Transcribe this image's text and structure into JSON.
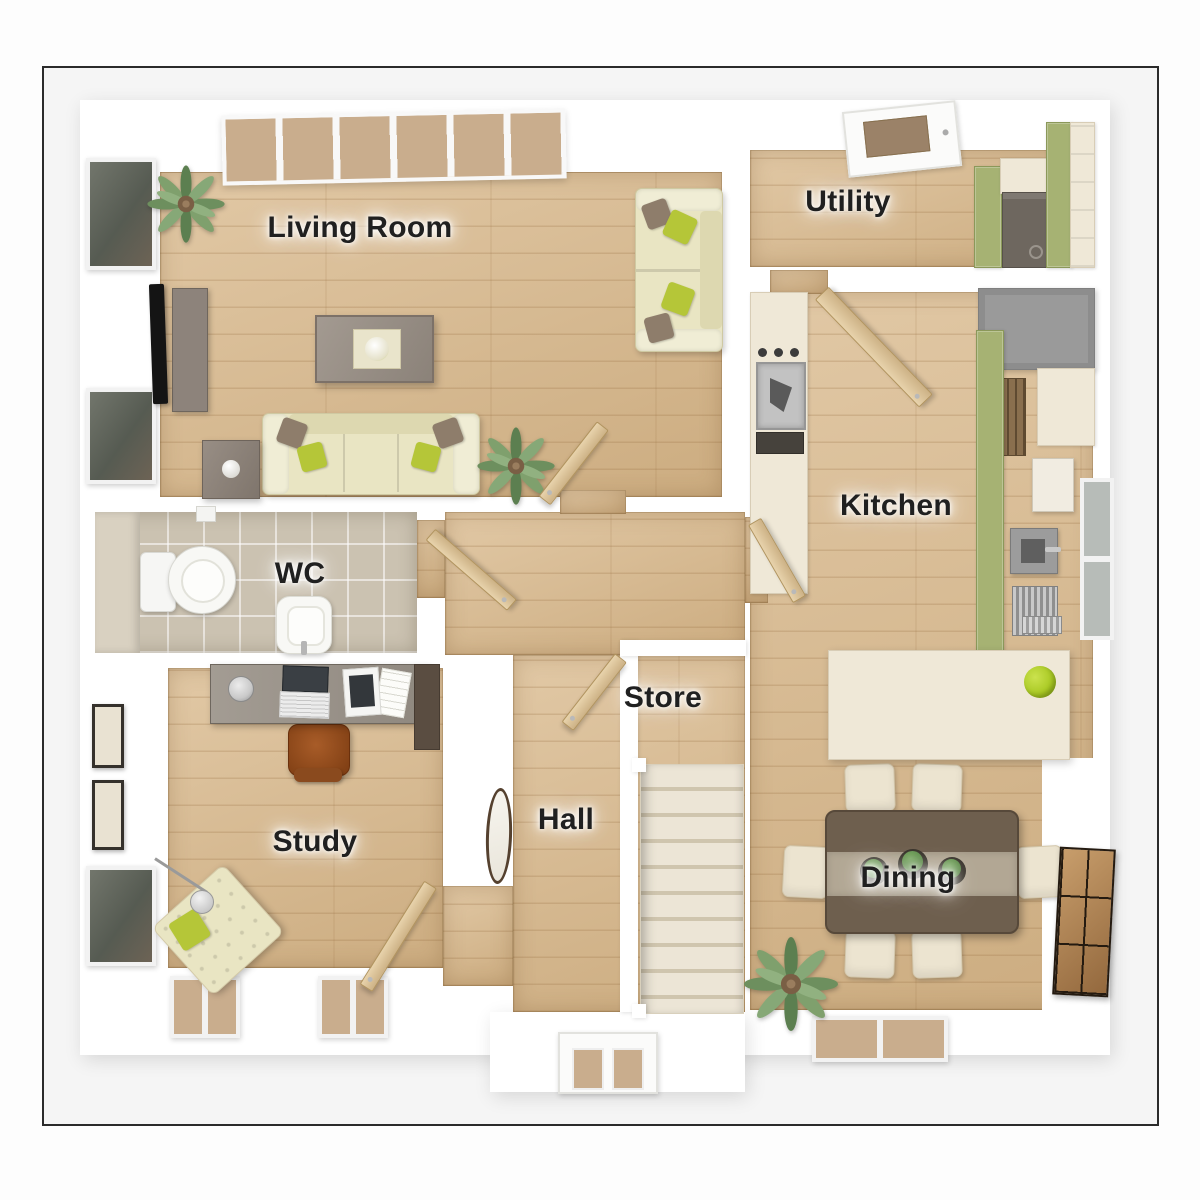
{
  "rooms": [
    {
      "id": "living-room",
      "label": "Living Room"
    },
    {
      "id": "utility",
      "label": "Utility"
    },
    {
      "id": "kitchen",
      "label": "Kitchen"
    },
    {
      "id": "wc",
      "label": "WC"
    },
    {
      "id": "store",
      "label": "Store"
    },
    {
      "id": "hall",
      "label": "Hall"
    },
    {
      "id": "study",
      "label": "Study"
    },
    {
      "id": "dining",
      "label": "Dining"
    }
  ],
  "palette": {
    "page_bg": "#fdfdfd",
    "frame_bg": "#f5f5f5",
    "frame_border": "#2b2b2b",
    "wall": "#ffffff",
    "wood": "#d9b98c",
    "tile": "#cbc2b1",
    "olive": "#a6b273",
    "cream": "#efe8d7",
    "sofa": "#e9e5c3",
    "pillow_green": "#b5c638",
    "pillow_brown": "#8e7d6b",
    "door_tan": "#dfc9a1",
    "table_brown": "#6e5f4e",
    "chair_cream": "#ece4d0",
    "glass_tan": "#c9ad8d",
    "glass_dark": "#565b52",
    "stairs": "#e9e2d3",
    "label": "#202020"
  }
}
